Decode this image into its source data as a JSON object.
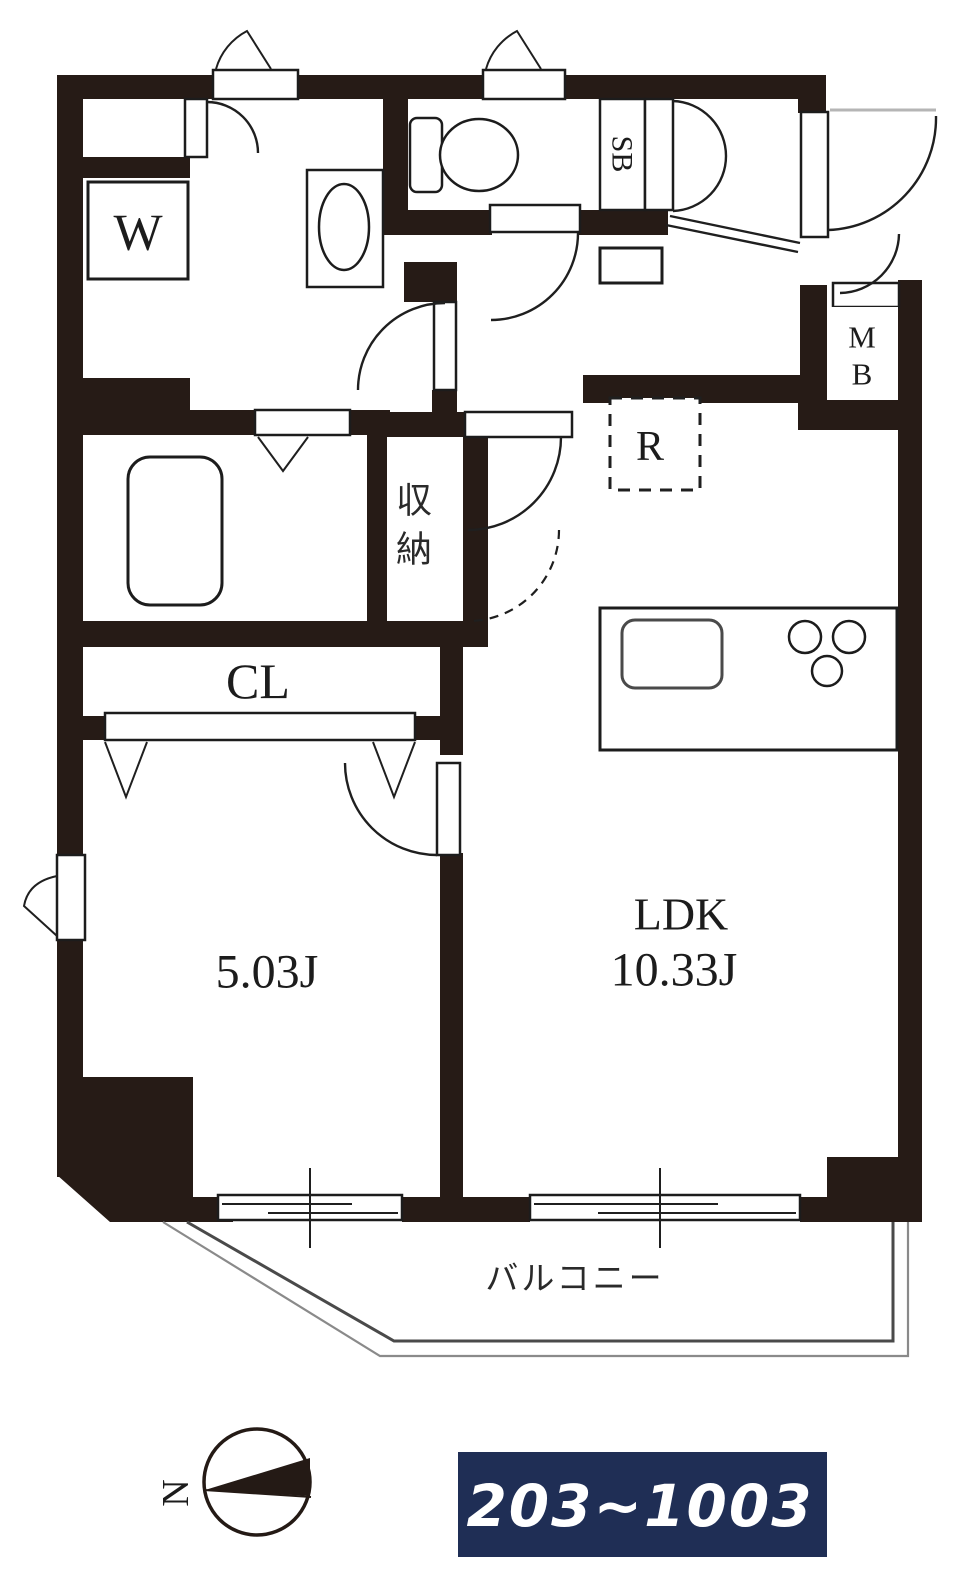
{
  "plan": {
    "rooms": {
      "bedroom_size": "5.03J",
      "ldk_name": "LDK",
      "ldk_size": "10.33J",
      "closet": "CL",
      "storage_char1": "収",
      "storage_char2": "納",
      "balcony": "バルコニー"
    },
    "equipment": {
      "washer": "W",
      "shoe_box": "SB",
      "meter_box_char1": "M",
      "meter_box_char2": "B",
      "refrigerator": "R"
    },
    "compass": {
      "north": "N"
    },
    "badge": {
      "text": "203~1003",
      "bg": "#1f2e55",
      "fg": "#ffffff"
    },
    "colors": {
      "wall": "#261b16",
      "line": "#1c1c1c"
    }
  }
}
